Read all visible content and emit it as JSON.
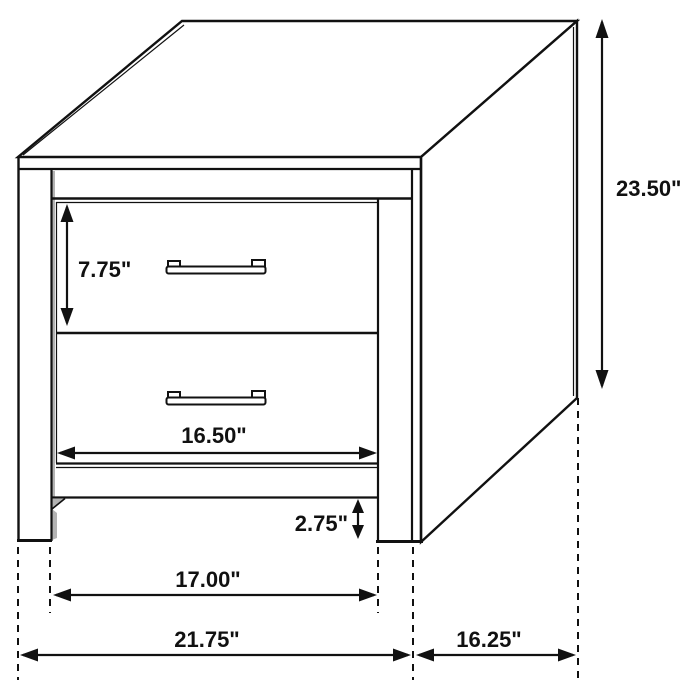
{
  "colors": {
    "ink": "#111111",
    "shade": "#b3b3b3",
    "bg": "#ffffff"
  },
  "diagram": {
    "subject": "two-drawer-nightstand",
    "unit": "inches",
    "drawer_count": 2
  },
  "dims": {
    "height": {
      "label": "23.50\"",
      "inches": 23.5
    },
    "drawer_height": {
      "label": "7.75\"",
      "inches": 7.75
    },
    "drawer_width": {
      "label": "16.50\"",
      "inches": 16.5
    },
    "clearance": {
      "label": "2.75\"",
      "inches": 2.75
    },
    "inner_width": {
      "label": "17.00\"",
      "inches": 17.0
    },
    "overall_width": {
      "label": "21.75\"",
      "inches": 21.75
    },
    "depth": {
      "label": "16.25\"",
      "inches": 16.25
    }
  }
}
